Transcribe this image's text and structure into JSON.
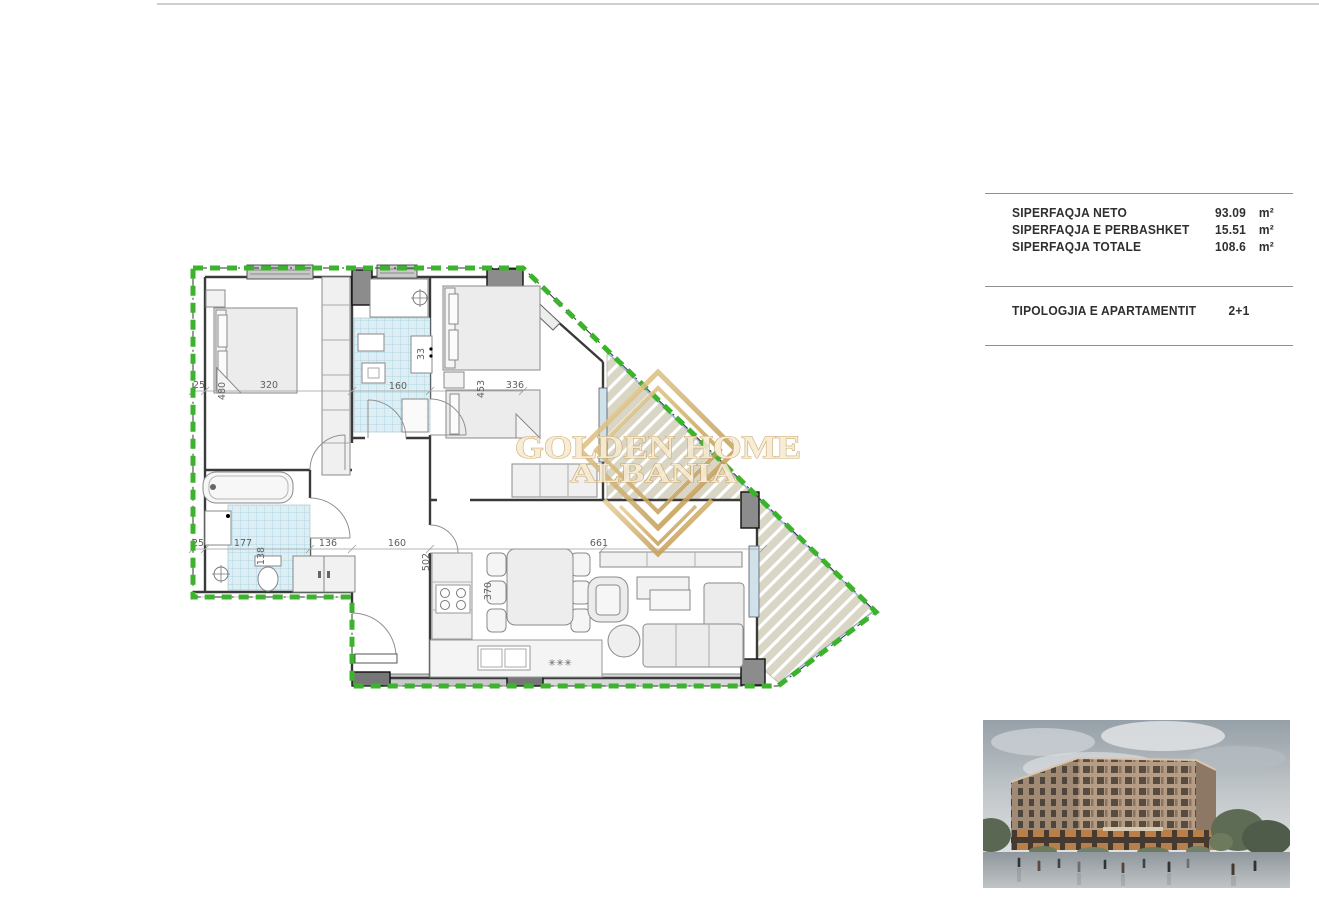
{
  "info_panel": {
    "rows": [
      {
        "label": "SIPERFAQJA NETO",
        "value": "93.09",
        "unit": "m²"
      },
      {
        "label": "SIPERFAQJA E PERBASHKET",
        "value": "15.51",
        "unit": "m²"
      },
      {
        "label": "SIPERFAQJA TOTALE",
        "value": "108.6",
        "unit": "m²"
      }
    ],
    "typology": {
      "label": "TIPOLOGJIA E APARTAMENTIT",
      "value": "2+1"
    }
  },
  "watermark": {
    "line1": "GOLDEN HOME",
    "line2": "ALBANIA",
    "gold": "#c9a45f"
  },
  "floorplan": {
    "boundary_color": "#3cb32c",
    "tile_color": "#ddeef4",
    "dim_labels": [
      {
        "text": "25"
      },
      {
        "text": "480"
      },
      {
        "text": "320"
      },
      {
        "text": "160"
      },
      {
        "text": "453"
      },
      {
        "text": "336"
      },
      {
        "text": "25"
      },
      {
        "text": "177"
      },
      {
        "text": "138"
      },
      {
        "text": "136"
      },
      {
        "text": "160"
      },
      {
        "text": "502"
      },
      {
        "text": "370"
      },
      {
        "text": "661"
      },
      {
        "text": "33"
      },
      {
        "text": "✳✳✳"
      }
    ]
  }
}
